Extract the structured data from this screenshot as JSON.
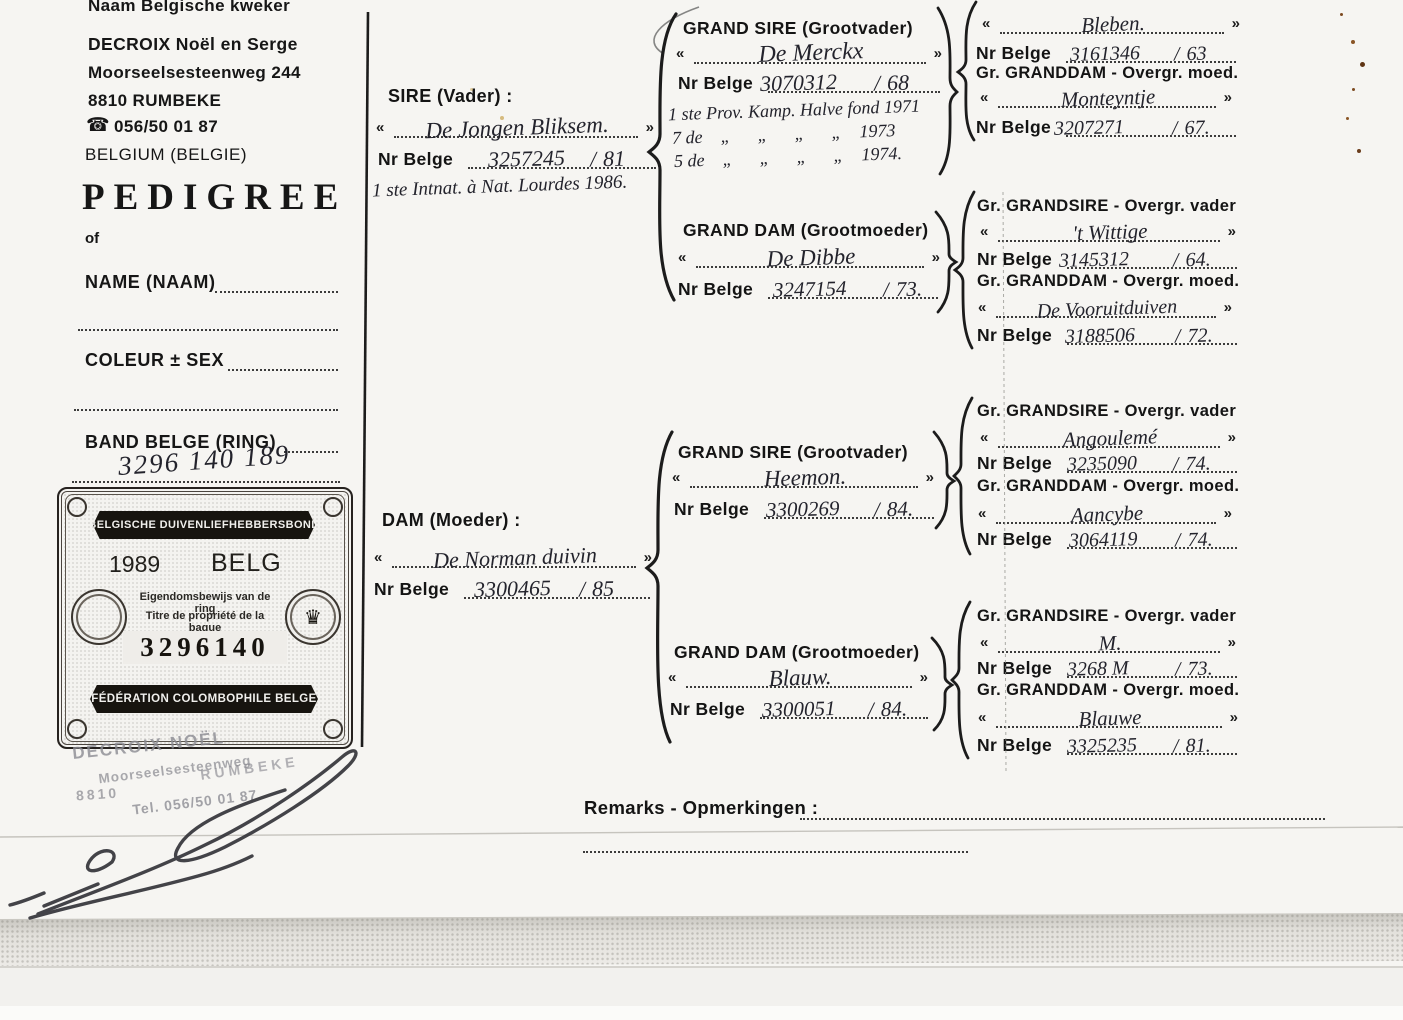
{
  "breeder": {
    "label": "Naam Belgische kweker",
    "name": "DECROIX Noël en Serge",
    "street": "Moorseelsesteenweg 244",
    "city": "8810 RUMBEKE",
    "phone": "056/50 01 87",
    "phone_icon": "☎",
    "country": "BELGIUM (BELGIE)"
  },
  "form": {
    "title": "PEDIGREE",
    "of": "of",
    "name_label": "NAME (NAAM)",
    "colour_label": "COLEUR ± SEX",
    "band_label": "BAND BELGE (RING)",
    "band_value": "3296 140 189"
  },
  "certificate": {
    "title_nl": "BELGISCHE DUIVENLIEFHEBBERSBOND",
    "year": "1989",
    "country_code": "BELG",
    "ownership_nl": "Eigendomsbewijs van de ring",
    "ownership_fr": "Titre de propriété de la bague",
    "ring": "3296140",
    "title_fr": "FÉDÉRATION COLOMBOPHILE BELGE",
    "crown_icon": "♛"
  },
  "stamp": {
    "name": "DECROIX NOËL",
    "street": "Moorseelsesteenweg",
    "postal": "8810",
    "city": "RUMBEKE",
    "tel": "Tel. 056/50 01 87"
  },
  "labels": {
    "nr_belge": "Nr Belge",
    "open_quote": "«",
    "close_quote": "»",
    "slash": "/",
    "grand_sire": "GRAND SIRE (Grootvader)",
    "grand_dam": "GRAND DAM (Grootmoeder)",
    "gr_grandsire": "Gr. GRANDSIRE - Overgr. vader",
    "gr_granddam": "Gr. GRANDDAM - Overgr. moed."
  },
  "sire": {
    "header": "SIRE (Vader) :",
    "name": "De Jongen Bliksem.",
    "ring": "3257245",
    "year": "81",
    "note": "1 ste Intnat. à Nat. Lourdes 1986."
  },
  "dam": {
    "header": "DAM (Moeder) :",
    "name": "De Norman duivin",
    "ring": "3300465",
    "year": "85"
  },
  "grand_sire_paternal": {
    "name": "De Merckx",
    "ring": "3070312",
    "year": "68",
    "note1": "1 ste Prov. Kamp. Halve fond 1971",
    "note2": "7 de    „      „      „      „    1973",
    "note3": "5 de    „      „      „      „    1974."
  },
  "grand_dam_paternal": {
    "name": "De Dibbe",
    "ring": "3247154",
    "year": "73."
  },
  "grand_sire_maternal": {
    "name": "Heemon.",
    "ring": "3300269",
    "year": "84."
  },
  "grand_dam_maternal": {
    "name": "Blauw.",
    "ring": "3300051",
    "year": "84."
  },
  "great_grandparents": [
    {
      "sire_name": "Bleben.",
      "sire_ring": "3161346",
      "sire_year": "63",
      "dam_name": "Monteyntje",
      "dam_ring": "3207271",
      "dam_year": "67."
    },
    {
      "sire_name": "'t Wittige",
      "sire_ring": "3145312",
      "sire_year": "64.",
      "dam_name": "De Vooruitduiven",
      "dam_ring": "3188506",
      "dam_year": "72."
    },
    {
      "sire_name": "Angoulemé",
      "sire_ring": "3235090",
      "sire_year": "74.",
      "dam_name": "Aancybe",
      "dam_ring": "3064119",
      "dam_year": "74."
    },
    {
      "sire_name": "M.",
      "sire_ring": "3268 M",
      "sire_year": "73.",
      "dam_name": "Blauwe",
      "dam_ring": "3325235",
      "dam_year": "81."
    }
  ],
  "remarks": {
    "label": "Remarks - Opmerkingen :"
  }
}
